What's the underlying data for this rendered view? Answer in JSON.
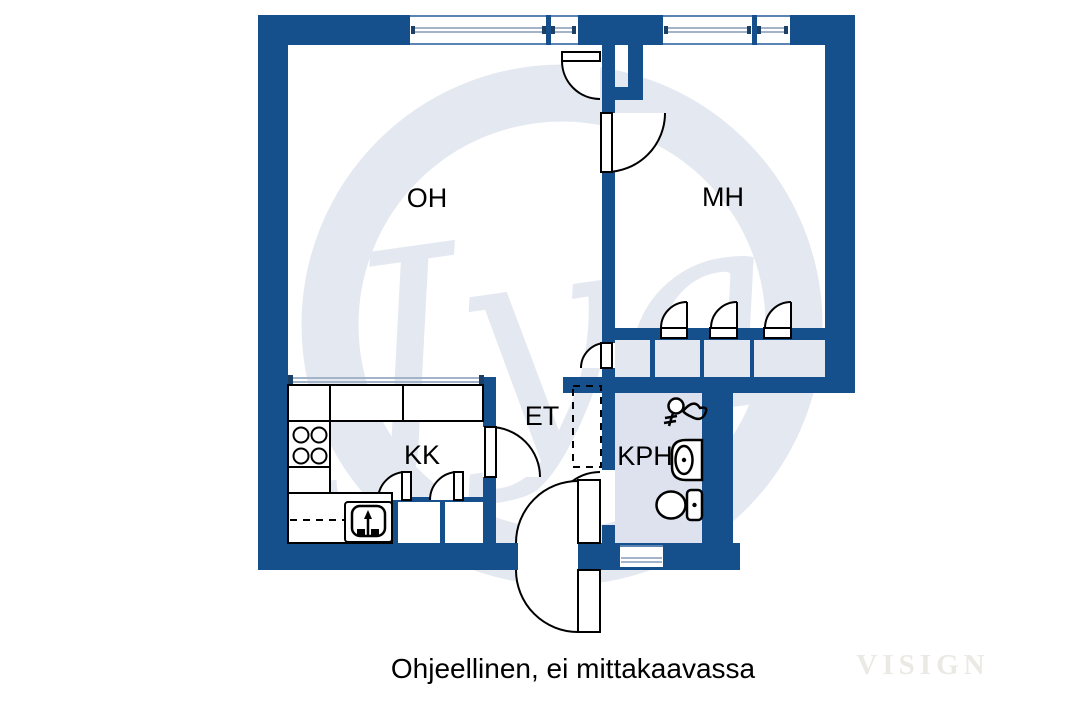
{
  "colors": {
    "wall": "#15508d",
    "glass_line": "#a3b4ca",
    "window_edge": "#5b84b4",
    "wet_room_fill": "#dde2ee",
    "closet_fill": "#e3e7ef",
    "watermark": "#e4e8f0",
    "brand": "#ebe9e3",
    "background": "#ffffff"
  },
  "labels": {
    "oh": "OH",
    "mh": "MH",
    "kk": "KK",
    "et": "ET",
    "kph": "KPH"
  },
  "caption": "Ohjeellinen, ei mittakaavassa",
  "watermark_text": "Jya",
  "brand_text": "VISIGN"
}
